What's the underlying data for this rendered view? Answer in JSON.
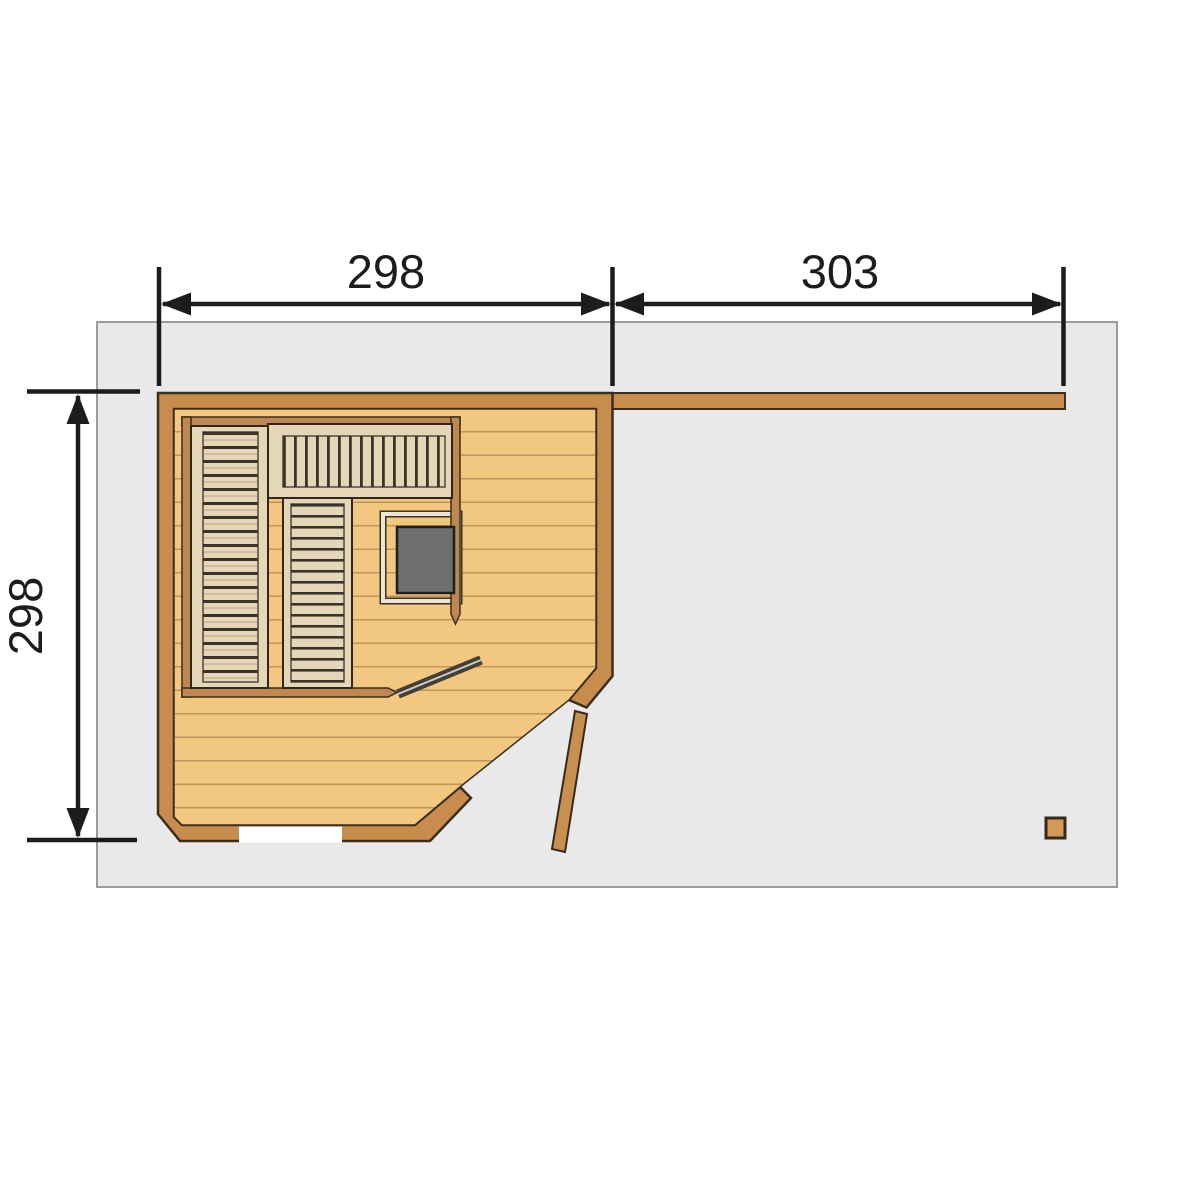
{
  "title": "Sauna floor plan",
  "dimensions": {
    "top_width": "298",
    "top_right_width": "303",
    "left_height": "298"
  },
  "colors": {
    "platform": "#e9e9e9",
    "platform_border": "#9c9c9c",
    "wall": "#c88c4d",
    "wall_outline": "#3a2e1e",
    "cabin_wall": "#bd8851",
    "floor": "#f2c77f",
    "plank_line": "#c3945a",
    "bench": "#e6d6b8",
    "bench_slat_line": "#3b332a",
    "bench_outline": "#2f271f",
    "heater": "#6f6f6f",
    "heater_guard": "#ece4d4",
    "glass_door": "#463f38",
    "entrance_door": "#c8904f",
    "dimension": "#1c1c1c",
    "threshold": "#ffffff"
  },
  "elements": {
    "platform": "deck platform",
    "privacy_wall": "privacy wall",
    "anteroom": "anteroom floor",
    "cabin": "sauna cabin",
    "bench_left": "bench left",
    "bench_top": "bench top",
    "bench_middle": "bench middle",
    "heater": "sauna heater",
    "heater_guard": "heater guard rail",
    "glass_door": "sauna glass door (open)",
    "entrance_door": "entrance door (open)",
    "support_post": "support post",
    "threshold_window": "threshold opening"
  }
}
